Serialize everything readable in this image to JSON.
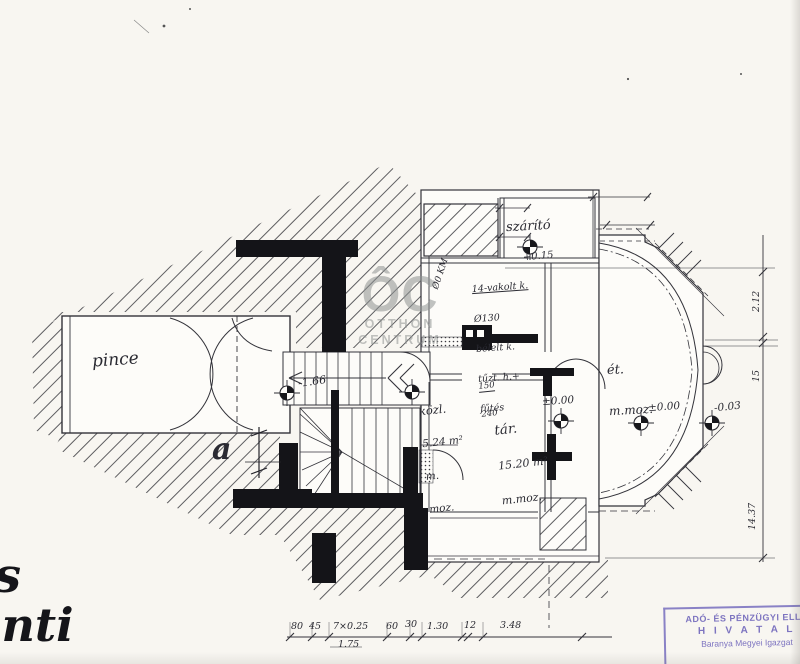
{
  "watermark": {
    "monogram": "ÔC",
    "word1": "OTTHON",
    "word2": "CENTRUM"
  },
  "rooms": {
    "pince": {
      "label": "pince"
    },
    "szarito": {
      "label": "szárító"
    },
    "kozl": {
      "label": "közl.",
      "area": "5.24 m²",
      "f1": "m.",
      "f2": "moz."
    },
    "tar": {
      "label": "tár.",
      "area": "15.20 m²",
      "finish": "m.moz."
    },
    "et": {
      "label": "ét.",
      "finish": "m.moz."
    }
  },
  "levels": {
    "pince": "-1.66",
    "szarito": "+0.15",
    "tar": "±0.00",
    "et": "±0.00",
    "et2": "-0.03"
  },
  "annotations": {
    "chimney": [
      "14-vakolt k.",
      "Ø130",
      "bélelt k.",
      "tűzt. h.+",
      "fűtés"
    ],
    "door_w": "150",
    "door_h": "240",
    "flue1": "Ø0",
    "flue2": "KM",
    "section_letter": "a"
  },
  "dimensions": {
    "bottom": [
      "80",
      "45",
      "7×0.25",
      "60",
      "30",
      "1.30",
      "12",
      "3.48"
    ],
    "bottom_sub": "1.75",
    "right": [
      "2.12",
      "15",
      "14.37"
    ]
  },
  "margin": {
    "frag_top": "s",
    "frag_bottom": "inti"
  },
  "stamp": {
    "line1": "ADÓ- ÉS PÉNZÜGYI ELLE",
    "line2": "H I V A T A L",
    "line3": "Baranya Megyei Igazgat",
    "color": "#7d74c0"
  }
}
